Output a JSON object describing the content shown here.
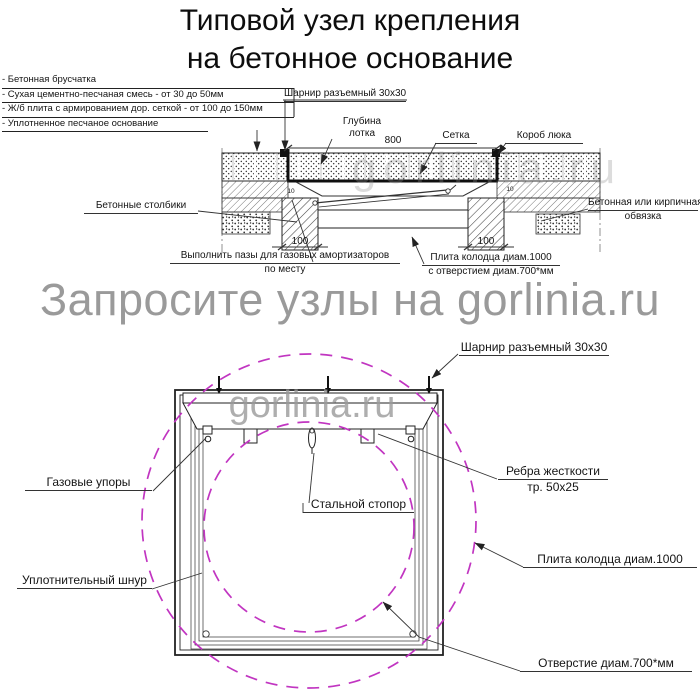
{
  "title": {
    "line1": "Типовой узел крепления",
    "line2": "на бетонное основание"
  },
  "watermark": {
    "main": "Запросите узлы на gorlinia.ru",
    "brand": "gorlinia.ru"
  },
  "section_view": {
    "legend": [
      "- Бетонная брусчатка",
      "- Сухая цементно-песчаная смесь - от 30 до 50мм",
      "- Ж/б плита с армированием дор. сеткой - от 100 до 150мм",
      "- Уплотненное песчаное основание"
    ],
    "labels": {
      "hinge": "Шарнир разъемный 30x30",
      "tray_depth_line1": "Глубина",
      "tray_depth_line2": "лотка",
      "mesh": "Сетка",
      "hatch_box": "Короб люка",
      "posts": "Бетонные столбики",
      "binding_line1": "Бетонная или кирпичная",
      "binding_line2": "обвязка",
      "grooves_line1": "Выполнить пазы для газовых амортизаторов",
      "grooves_line2": "по месту",
      "slab_line1": "Плита колодца диам.1000",
      "slab_line2": "с отверстием диам.700*мм"
    },
    "dimensions": {
      "lid_width": "800",
      "post_left": "100",
      "post_right": "100",
      "gap_left": "10",
      "gap_right": "10"
    }
  },
  "plan_view": {
    "labels": {
      "hinge": "Шарнир разъемный 30x30",
      "gas_struts": "Газовые упоры",
      "stopper": "Стальной стопор",
      "ribs_line1": "Ребра жесткости",
      "ribs_line2": "тр. 50x25",
      "slab": "Плита колодца диам.1000",
      "seal_cord": "Уплотнительный шнур",
      "opening": "Отверстие диам.700*мм"
    }
  },
  "colors": {
    "circle_accent": "#c135c1",
    "watermark_gray": "#9a9a9a",
    "line_dark": "#1c1c1c"
  }
}
